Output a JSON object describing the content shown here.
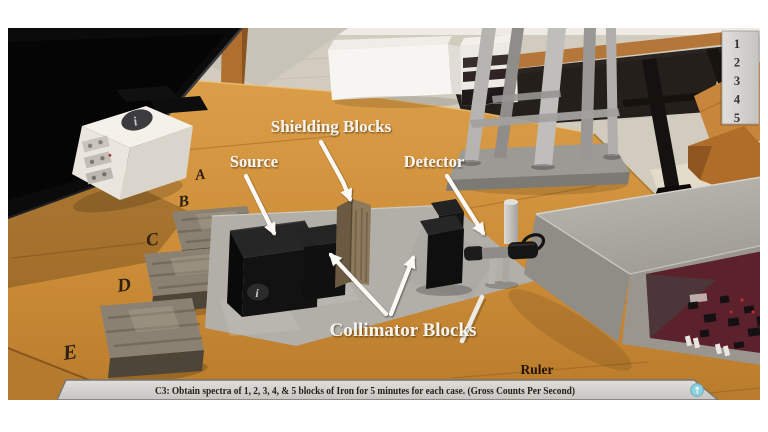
{
  "scene": {
    "annotations": {
      "shielding_blocks": "Shielding Blocks",
      "source": "Source",
      "detector": "Detector",
      "collimator_blocks": "Collimator Blocks",
      "ruler": "Ruler"
    },
    "row_letters": [
      "A",
      "B",
      "C",
      "D",
      "E"
    ],
    "shelf_numbers": [
      "1",
      "2",
      "3",
      "4",
      "5"
    ],
    "info_icon_glyph": "i"
  },
  "status_bar": {
    "text": "C3: Obtain spectra of 1, 2, 3, 4, & 5 blocks of Iron for 5 minutes for each case. (Gross Counts Per Second)",
    "expand_icon_glyph": "↑"
  },
  "colors": {
    "table_wood": "#d0913c",
    "table_wood_dark": "#b0742a",
    "floor": "#d2ccbf",
    "mat_gray": "#b2afa9",
    "label_white": "#f6f4ef",
    "status_bar_bg": "#d6d4d1",
    "help_icon_teal": "#8ed1df",
    "board_maroon": "#5c222c",
    "block_black": "#141414",
    "iron_brown": "#8b8172"
  }
}
